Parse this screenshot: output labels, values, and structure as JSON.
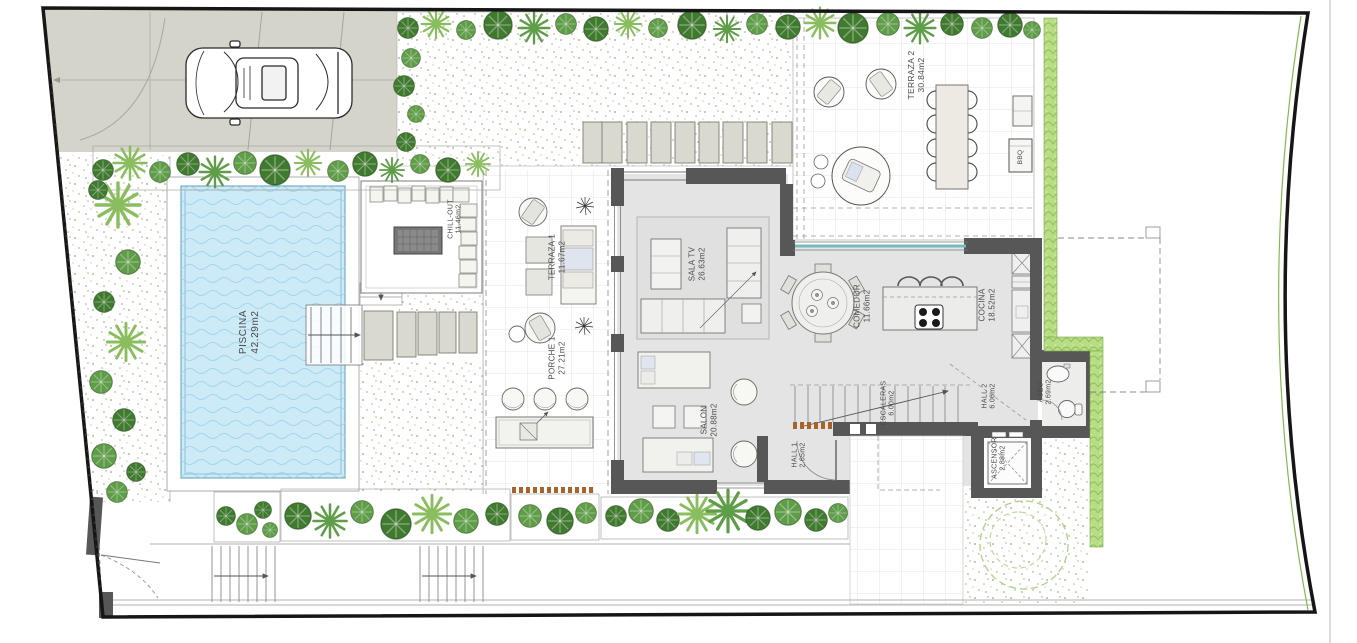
{
  "plan": {
    "type": "villa-ground-floor-site-plan",
    "units": "m2",
    "rooms": {
      "piscina": {
        "label": "PISCINA",
        "area": "42.29m2"
      },
      "chill_out": {
        "label": "CHILL-OUT",
        "area": "11.46m2"
      },
      "terraza1": {
        "label": "TERRAZA 1",
        "area": "11.67m2"
      },
      "porche1": {
        "label": "PORCHE 1",
        "area": "27.21m2"
      },
      "sala_tv": {
        "label": "SALA TV",
        "area": "26.63m2"
      },
      "salon": {
        "label": "SALON",
        "area": "20.88m2"
      },
      "comedor": {
        "label": "COMEDOR",
        "area": "11.66m2"
      },
      "cocina": {
        "label": "COCINA",
        "area": "18.52m2"
      },
      "escaleras": {
        "label": "ESCALERAS",
        "area": "6.00m2"
      },
      "hall2": {
        "label": "HALL 2",
        "area": "6.06m2"
      },
      "hall1": {
        "label": "HALL 1",
        "area": "2.65m2"
      },
      "aseo": {
        "label": "ASEO",
        "area": "2.69m2"
      },
      "ascensor": {
        "label": "ASCENSOR",
        "area": "2.88m2"
      },
      "terraza2": {
        "label": "TERRAZA 2",
        "area": "30.84m2"
      },
      "bbq": {
        "label": "BBQ",
        "area": ""
      }
    },
    "icons": {
      "car": "car-top-view",
      "bbq_unit": "bbq-grill",
      "elevator": "elevator-cabin",
      "toilet": "toilet",
      "sink": "sink",
      "stairs": "staircase",
      "gate": "entrance-gate",
      "pool_steps": "pool-steps-arrow"
    }
  },
  "colors": {
    "boundary": "#161616",
    "wall": "#575757",
    "interior_floor": "#e4e4e4",
    "pool_water": "#cdeaf7",
    "pool_wave": "#a3d6ea",
    "hedge": "#b9dd85",
    "tree_dark": "#3f7a2f",
    "tree_mid": "#5f9d48",
    "tree_light": "#8abd5e",
    "driveway": "#d4d4ca",
    "furniture": "#d9d9cf",
    "glass": "#76bcbc",
    "wood_accent": "#a8632a",
    "label_text": "#4a4a4a"
  }
}
